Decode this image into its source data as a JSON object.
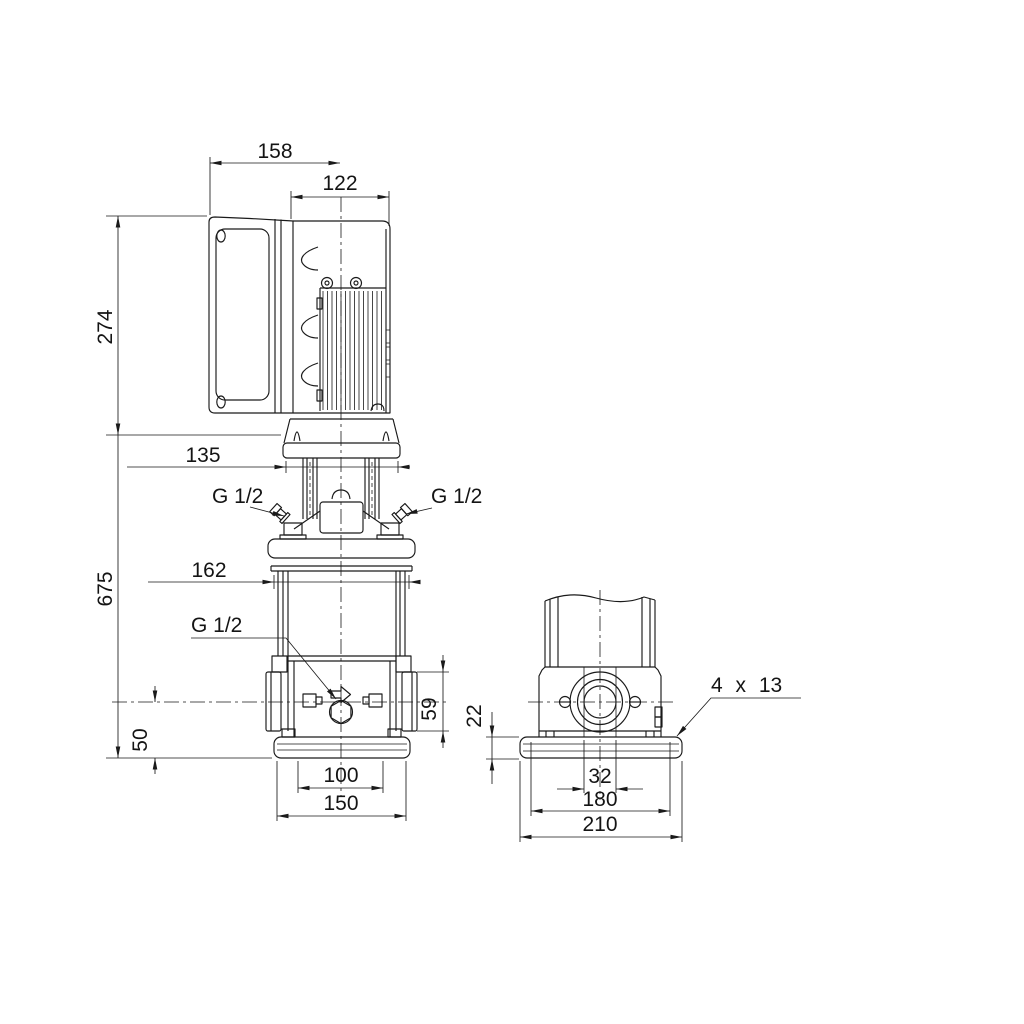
{
  "style": {
    "line_color": "#1a1a1a",
    "background": "#ffffff"
  },
  "front_view": {
    "dims": {
      "w158": "158",
      "w122": "122",
      "h274": "274",
      "w135": "135",
      "h675": "675",
      "w162": "162",
      "h50": "50",
      "h59": "59",
      "w100": "100",
      "w150": "150"
    },
    "labels": {
      "plug_left": "G 1/2",
      "plug_right": "G 1/2",
      "drain": "G 1/2"
    }
  },
  "side_view": {
    "dims": {
      "h22": "22",
      "w32": "32",
      "w180": "180",
      "w210": "210"
    },
    "labels": {
      "base_holes": "4 x 13"
    }
  }
}
